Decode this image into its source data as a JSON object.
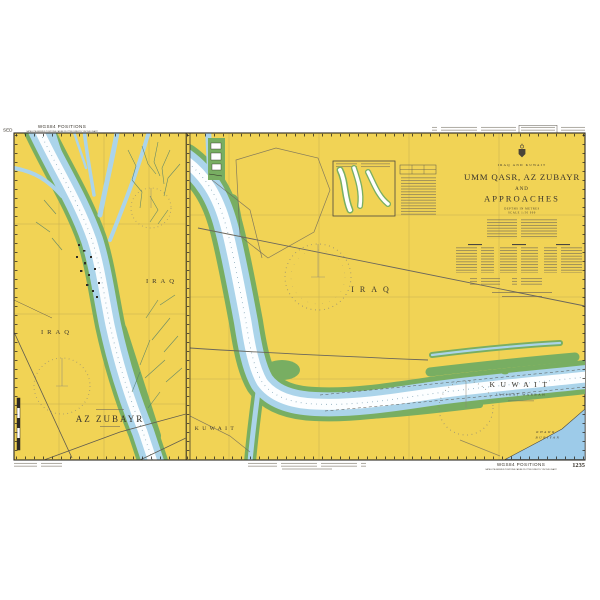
{
  "colors": {
    "land": "#f1d355",
    "water": "#abd4ea",
    "channel": "#ffffff",
    "intertidal": "#78ae62",
    "sea": "#9dcbe9",
    "ink": "#3a352c"
  },
  "margins": {
    "fold_label": "SED",
    "wgs_top": "WGS84 POSITIONS",
    "wgs_top_sub": "SATELLITE-DERIVED POSITIONS CAN BE PLOTTED DIRECTLY ON THIS CHART",
    "wgs_bottom": "WGS84 POSITIONS",
    "wgs_bottom_sub": "SATELLITE-DERIVED POSITIONS CAN BE PLOTTED DIRECTLY ON THIS CHART",
    "chart_number": "1235"
  },
  "title_block": {
    "region": "IRAQ AND KUWAIT",
    "title_line1": "UMM QASR, AZ ZUBAYR",
    "title_line2": "AND",
    "title_line3": "APPROACHES",
    "depths_note": "DEPTHS IN METRES",
    "scale_note": "SCALE 1:50 000"
  },
  "left_panel": {
    "label_iraq_west": "IRAQ",
    "label_iraq_east": "IRAQ",
    "inset_title": "AZ ZUBAYR"
  },
  "main_panel": {
    "label_iraq": "IRAQ",
    "label_kuwait_small": "KUWAIT",
    "label_kuwait_large": "KUWAIT",
    "label_kuwait_sub": "JAZIRAT WARBAH",
    "sea_label_line1": "KHAWR",
    "sea_label_line2": "BUBIYAN"
  }
}
